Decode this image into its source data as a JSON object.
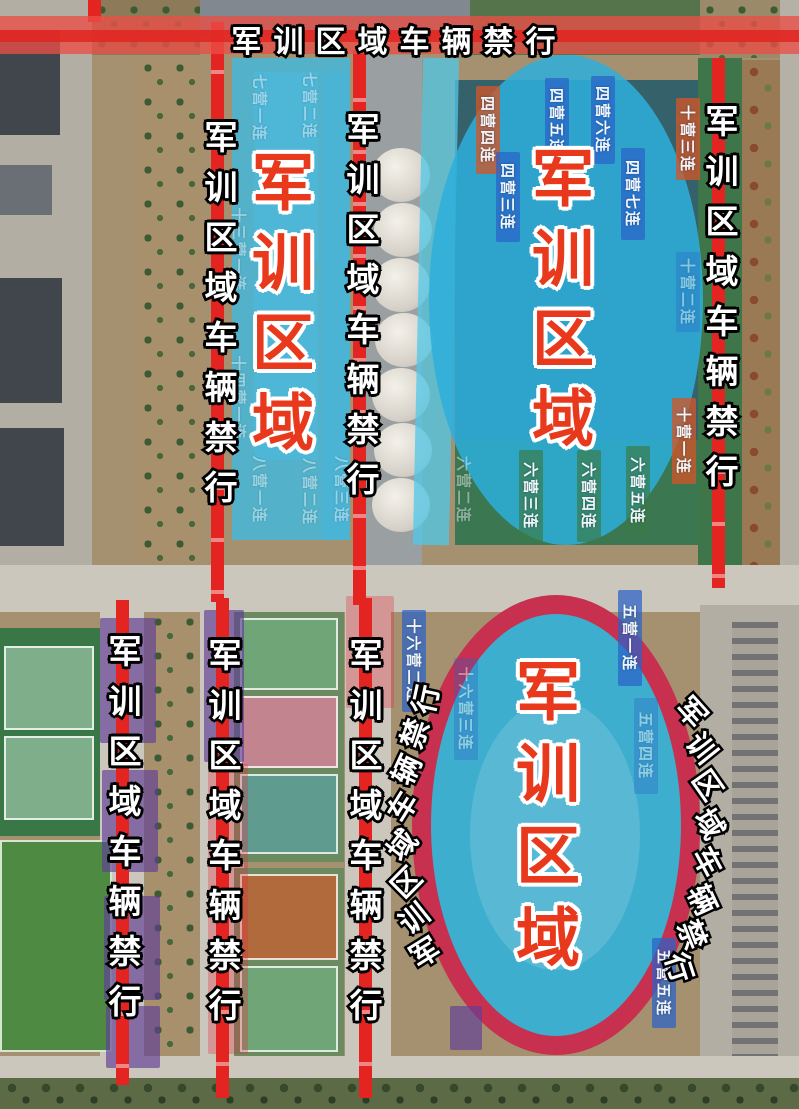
{
  "banner": {
    "text": "军训区域车辆禁行"
  },
  "zone_titles": {
    "left": "军训区域",
    "top_right": "军训区域",
    "stadium": "军训区域"
  },
  "road_text": "军训区域车辆禁行",
  "curved": {
    "left": "军训区域车辆禁行",
    "right": "军训区域车辆禁行"
  },
  "colors": {
    "prohibit_red": "#e42420",
    "banner_red": "#ea4e46",
    "zone_cyan": "#2fb0da",
    "title_red": "#e8391d",
    "ring_crimson": "#c7304f",
    "label_blue": "#2a62c8",
    "label_orange": "#d05828",
    "label_green": "#3a7a4a",
    "label_purple": "#5f3e96"
  },
  "unit_labels": [
    {
      "text": "七营一连",
      "x": 248,
      "y": 66,
      "h": 84,
      "bg": "none",
      "faint": true
    },
    {
      "text": "七营二连",
      "x": 298,
      "y": 64,
      "h": 84,
      "bg": "none",
      "faint": true
    },
    {
      "text": "十三营一连",
      "x": 227,
      "y": 200,
      "h": 100,
      "bg": "none",
      "faint": true
    },
    {
      "text": "十四营一连",
      "x": 227,
      "y": 348,
      "h": 100,
      "bg": "none",
      "faint": true
    },
    {
      "text": "八营一连",
      "x": 248,
      "y": 446,
      "h": 88,
      "bg": "none",
      "faint": true
    },
    {
      "text": "八营二连",
      "x": 298,
      "y": 448,
      "h": 88,
      "bg": "none",
      "faint": true
    },
    {
      "text": "八营三连",
      "x": 330,
      "y": 446,
      "h": 88,
      "bg": "none",
      "faint": true
    },
    {
      "text": "四营四连",
      "x": 476,
      "y": 86,
      "h": 88,
      "bg": "orange",
      "faint": false
    },
    {
      "text": "四营五连",
      "x": 545,
      "y": 78,
      "h": 88,
      "bg": "blue",
      "faint": false
    },
    {
      "text": "四营六连",
      "x": 591,
      "y": 76,
      "h": 88,
      "bg": "blue",
      "faint": false
    },
    {
      "text": "四营三连",
      "x": 496,
      "y": 152,
      "h": 90,
      "bg": "blue",
      "faint": false
    },
    {
      "text": "四营七连",
      "x": 621,
      "y": 148,
      "h": 92,
      "bg": "blue",
      "faint": false
    },
    {
      "text": "十营三连",
      "x": 676,
      "y": 98,
      "h": 82,
      "bg": "orange",
      "faint": false
    },
    {
      "text": "十营二连",
      "x": 676,
      "y": 252,
      "h": 80,
      "bg": "blue",
      "faint": true
    },
    {
      "text": "十营一连",
      "x": 672,
      "y": 398,
      "h": 86,
      "bg": "orange",
      "faint": false
    },
    {
      "text": "六营二连",
      "x": 452,
      "y": 446,
      "h": 88,
      "bg": "none",
      "faint": true
    },
    {
      "text": "六营三连",
      "x": 519,
      "y": 450,
      "h": 92,
      "bg": "green",
      "faint": false
    },
    {
      "text": "六营四连",
      "x": 577,
      "y": 450,
      "h": 92,
      "bg": "green",
      "faint": false
    },
    {
      "text": "六营五连",
      "x": 626,
      "y": 446,
      "h": 90,
      "bg": "green",
      "faint": false
    },
    {
      "text": "十六营二连",
      "x": 402,
      "y": 610,
      "h": 102,
      "bg": "blue",
      "faint": false
    },
    {
      "text": "十六营三连",
      "x": 454,
      "y": 658,
      "h": 102,
      "bg": "blue",
      "faint": true
    },
    {
      "text": "五营一连",
      "x": 618,
      "y": 590,
      "h": 96,
      "bg": "blue",
      "faint": false
    },
    {
      "text": "五营四连",
      "x": 634,
      "y": 698,
      "h": 96,
      "bg": "blue",
      "faint": true
    },
    {
      "text": "五营五连",
      "x": 652,
      "y": 938,
      "h": 90,
      "bg": "blue",
      "faint": false
    }
  ]
}
